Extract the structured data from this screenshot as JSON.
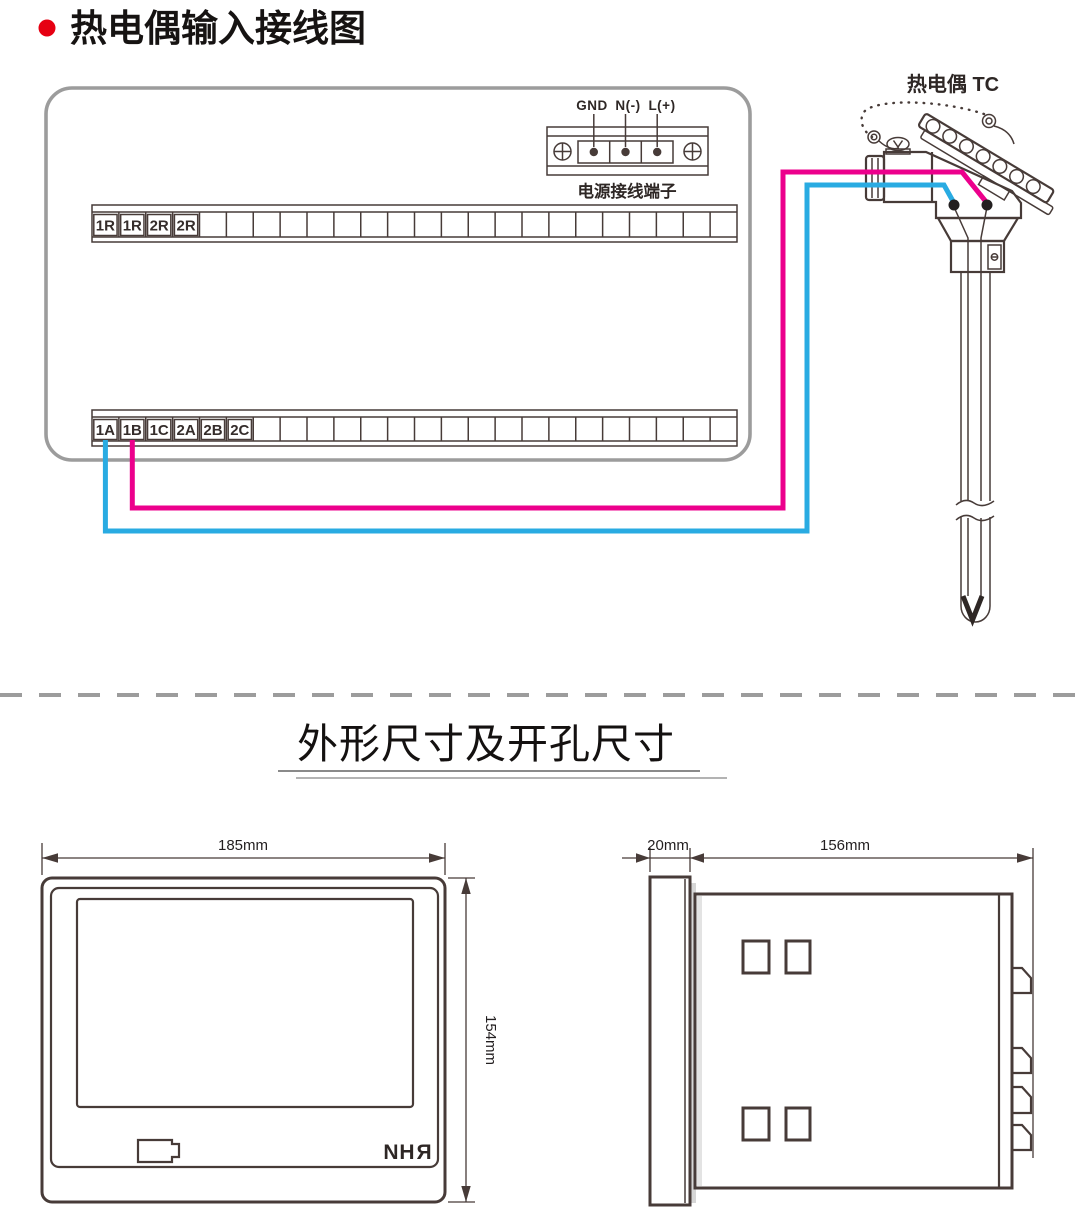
{
  "header": {
    "title": "热电偶输入接线图",
    "bullet_color": "#e60012"
  },
  "wiring_diagram": {
    "tc_label": "热电偶 TC",
    "power_terminal": {
      "labels": [
        "GND",
        "N(-)",
        "L(+)"
      ],
      "caption": "电源接线端子"
    },
    "top_terminal_strip": {
      "labels": [
        "1R",
        "1R",
        "2R",
        "2R"
      ]
    },
    "bottom_terminal_strip": {
      "labels": [
        "1A",
        "1B",
        "1C",
        "2A",
        "2B",
        "2C"
      ]
    },
    "colors": {
      "wire_positive": "#ec008c",
      "wire_negative": "#29abe2"
    }
  },
  "dimensions_section": {
    "title": "外形尺寸及开孔尺寸",
    "front_view": {
      "width": "185mm",
      "height": "154mm",
      "logo_letters": [
        "N",
        "H",
        "R"
      ]
    },
    "side_view": {
      "bezel_depth": "20mm",
      "body_depth": "156mm"
    }
  }
}
